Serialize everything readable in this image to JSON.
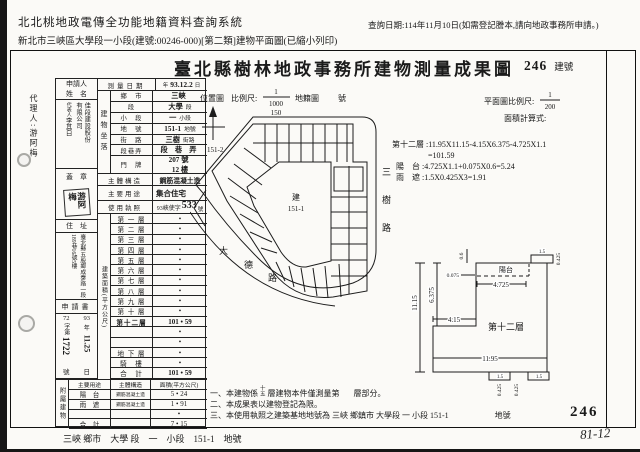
{
  "header": {
    "system_title": "北北桃地政電傳全功能地籍資料查詢系統",
    "query_date": "查詢日期:114年11月10日(如需登記謄本,請向地政事務所申請。)",
    "subtitle": "新北市三峽區大學段一小段(建號:00246-000)[第二類]建物平面圖(已縮小列印)"
  },
  "doc": {
    "title": "臺北縣樹林地政事務所建物測量成果圖",
    "building_no": "246",
    "building_no_label": "建號"
  },
  "margin": {
    "agent": "代理人:游阿梅"
  },
  "form": {
    "applicant_label_1": "申請人",
    "applicant_label_2": "姓　名",
    "applicant_name_col1": "佳段建設股份",
    "applicant_name_col2": "有限公司",
    "rep_label": "代表人",
    "rep_name": "李其白",
    "seal_label": "蓋　章",
    "seal_text": "游阿梅",
    "address_label": "住　址",
    "address_col1": "臺北縣五股鄉成泰路一段",
    "address_col2": "189巷16號5樓",
    "application_label": "申請書",
    "app_no_prefix": "72",
    "app_no_mid": "字第",
    "app_no": "1722",
    "app_no_suffix": "號",
    "app_date_year": "93",
    "app_date_year_label": "年",
    "app_date": "11.25",
    "app_date_suffix": "日",
    "survey_label": "測量日期",
    "survey_prefix": "年",
    "survey_date": "93.12.2",
    "survey_suffix": "日",
    "location_label": "建物坐落",
    "location_rows": [
      {
        "label": "鄉　市",
        "value": "三峽",
        "suffix": ""
      },
      {
        "label": "段",
        "value": "大學",
        "suffix": "段"
      },
      {
        "label": "小　段",
        "value": "一",
        "suffix": "小段"
      },
      {
        "label": "地　號",
        "value": "151-1",
        "suffix": "地號"
      },
      {
        "label": "街　路",
        "value": "三樹",
        "suffix": "街路"
      },
      {
        "label": "段巷弄",
        "value": "段　巷　弄",
        "suffix": ""
      },
      {
        "label": "門　牌",
        "value": "207 號",
        "suffix": "",
        "value2": "12 樓"
      }
    ],
    "structure_label": "主體構造",
    "structure": "鋼筋混凝土造",
    "use_label": "主要用途",
    "use": "集合住宅",
    "license_label": "使用執照",
    "license_prefix": "93峽使字",
    "license_no": "533",
    "license_suffix": "號",
    "area_label": "建築面積(平方公尺)",
    "floors": [
      {
        "label": "第 一 層",
        "value": "•"
      },
      {
        "label": "第 二 層",
        "value": "•"
      },
      {
        "label": "第 三 層",
        "value": "•"
      },
      {
        "label": "第 四 層",
        "value": "•"
      },
      {
        "label": "第 五 層",
        "value": "•"
      },
      {
        "label": "第 六 層",
        "value": "•"
      },
      {
        "label": "第 七 層",
        "value": "•"
      },
      {
        "label": "第 八 層",
        "value": "•"
      },
      {
        "label": "第 九 層",
        "value": "•"
      },
      {
        "label": "第 十 層",
        "value": "•"
      },
      {
        "label": "第十二層",
        "value": "101 • 59"
      },
      {
        "label": "",
        "value": "•"
      },
      {
        "label": "",
        "value": "•"
      },
      {
        "label": "地 下 層",
        "value": "•"
      },
      {
        "label": "騎　樓",
        "value": "•"
      },
      {
        "label": "合　計",
        "value": "101 • 59"
      }
    ],
    "annex_label": "附屬建物",
    "annex_headers": [
      "主要用途",
      "主體構造",
      "面積(平方公尺)"
    ],
    "annex_rows": [
      {
        "use": "陽　台",
        "structure": "鋼筋混凝土造",
        "area": "5 • 24"
      },
      {
        "use": "雨　遮",
        "structure": "鋼筋混凝土造",
        "area": "1 • 91"
      },
      {
        "use": "",
        "structure": "",
        "area": "•"
      },
      {
        "use": "合　計",
        "structure": "",
        "area": "7 • 15"
      }
    ]
  },
  "site_plan": {
    "label": "位置圖",
    "scale_label": "比例尺:",
    "scale_num": "1",
    "scale_den": "1000",
    "map_label": "地籍圖",
    "map_no": "150",
    "map_no_suffix": "號",
    "adjacent_lot": "151-2",
    "building_char": "建",
    "lot_no": "151-1",
    "road_right": [
      "三",
      "樹",
      "路"
    ],
    "road_bottom": [
      "大",
      "德",
      "路"
    ]
  },
  "floor_plan": {
    "scale_label": "平面圖比例尺:",
    "scale_num": "1",
    "scale_den": "200",
    "calc_label": "面積計算式:",
    "calc_line1": "第十二層 :11.95X11.15-4.15X6.375-4.725X1.1",
    "calc_line2": "=101.59",
    "calc_line3": "陽　台 :4.725X1.1+0.075X0.6=5.24",
    "calc_line4": "雨　遮 :1.5X0.425X3=1.91",
    "unit_label": "第十二層",
    "balcony_label": "陽台",
    "dims": {
      "height": "11.15",
      "height_upper": "6.375",
      "notch": "4.15",
      "width": "11.95",
      "balcony_w": "4.725",
      "balcony_step": "0.075",
      "step_h": "0.6",
      "eave": "0.425",
      "eave_len": "1.5"
    }
  },
  "notes": {
    "n1_pre": "一、本建物係",
    "n1_f1": "十",
    "n1_f2": "五",
    "n1_mid": "層建物本件僅測量第",
    "n1_post": "層部分。",
    "n2": "二、本成果表以建物登記為限。",
    "n3": "三、本使用執照之建築基地地號為 三峽 鄉鎮市 大學段 一 小段 151-1",
    "n3_suffix": "地號",
    "big_no": "246"
  },
  "footer": {
    "line": "三峽 鄉市　大學 段　一　小段　151-1　地號",
    "page_code": "81-12"
  }
}
